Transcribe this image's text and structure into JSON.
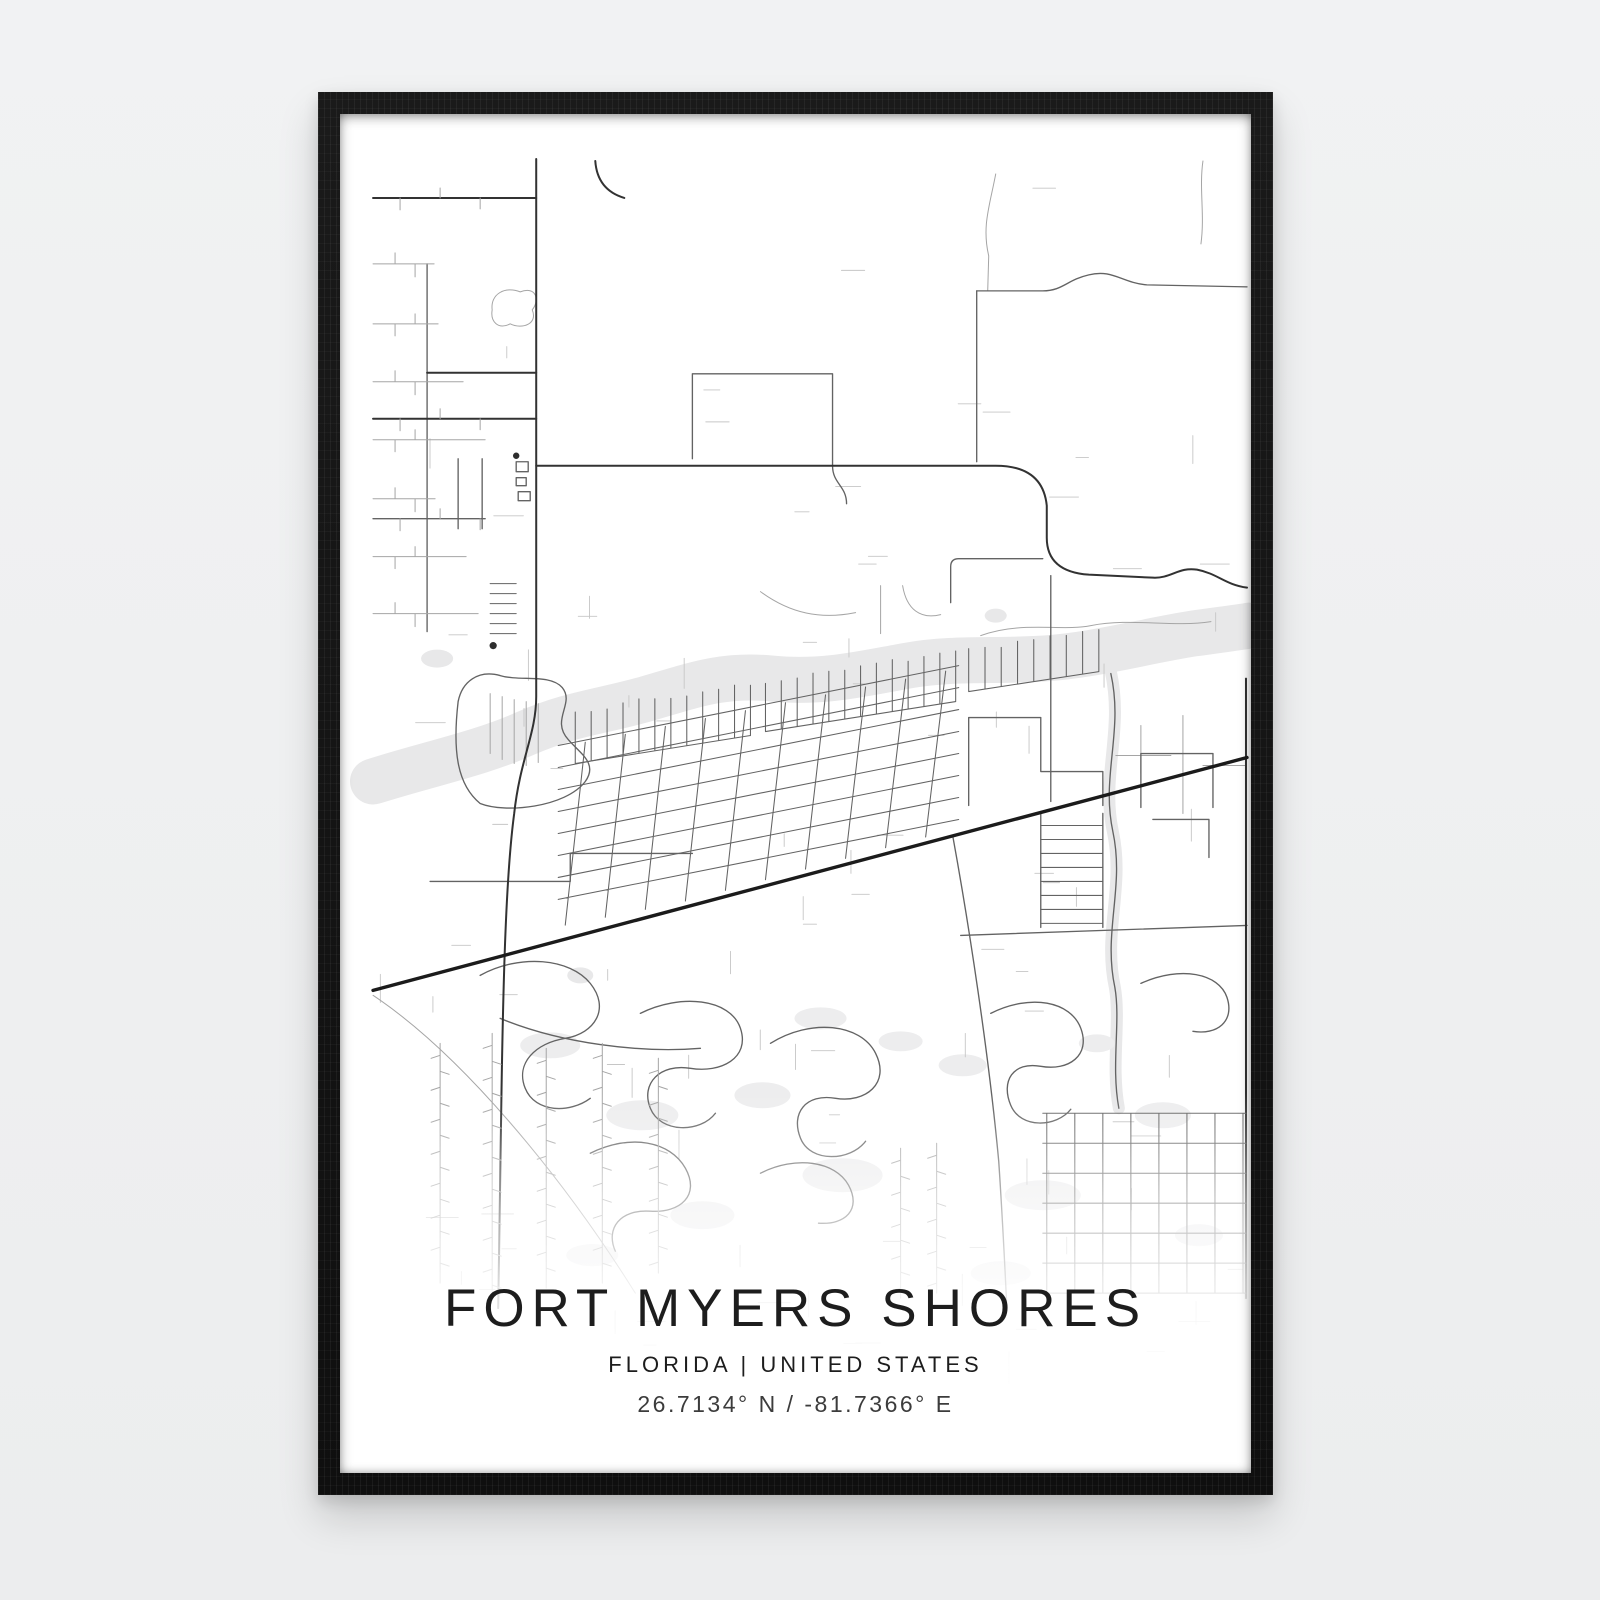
{
  "poster": {
    "title": "FORT MYERS SHORES",
    "subtitle": "FLORIDA | UNITED STATES",
    "coordinates": "26.7134° N / -81.7366° E"
  },
  "colors": {
    "page_bg": "#eff0f1",
    "frame": "#141414",
    "poster_bg": "#ffffff",
    "water": "#e8e8e9",
    "road_minor": "#c6c6c6",
    "road_light": "#a5a5a5",
    "road_medium": "#636363",
    "road_major": "#323232",
    "highway": "#1b1b1b",
    "title_text": "#1d1d1d",
    "coords_text": "#3c3c3c"
  }
}
